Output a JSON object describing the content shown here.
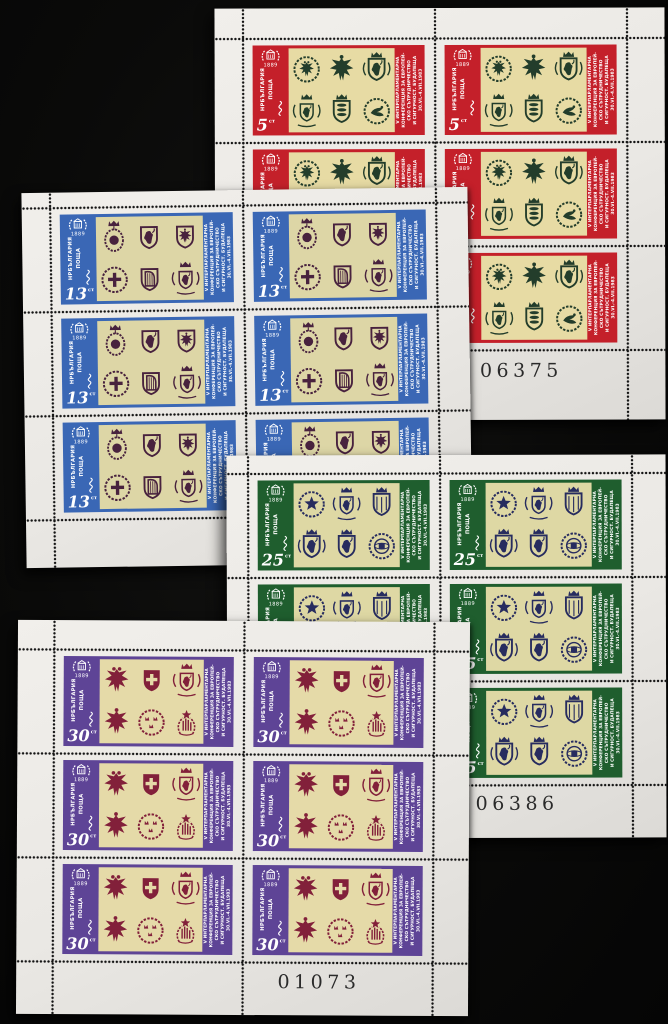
{
  "photo": {
    "background_color": "#0a0a09"
  },
  "shared": {
    "country_line1": "НРБЪЛГАРИЯ",
    "country_line2": "ПОЩА",
    "emblem_year": "1889",
    "currency_label": "ст",
    "side_text_lines": [
      "V ИНТЕРПАРЛАМЕНТАРНА",
      "КОНФЕРЕНЦИЯ ЗА ЕВРОПЕЙ-",
      "СКО СЪТРУДНИЧЕСТВО",
      "И СИГУРНОСТ. БУДАПЕЩА",
      "30.VI.-4.VII.1983"
    ]
  },
  "sheets": [
    {
      "id": "red-5",
      "denomination": "5",
      "serial": "06375",
      "frame_color": "#c4202a",
      "ink_color": "#233d2b",
      "panel_color": "#e7dba4",
      "arms": [
        {
          "label": "double-eagle-wreath-roundel",
          "glyph": "roundel:eagle"
        },
        {
          "label": "heraldic-eagle",
          "glyph": "eagle:1"
        },
        {
          "label": "crowned-lion-shield-with-supporters",
          "glyph": "shield:lion+crown+sup"
        },
        {
          "label": "royal-arms-with-supporters",
          "glyph": "royal"
        },
        {
          "label": "three-lions-crowned-shield",
          "glyph": "shield:lions+crown"
        },
        {
          "label": "dove-wreath-roundel",
          "glyph": "roundel:bird"
        }
      ]
    },
    {
      "id": "blue-13",
      "denomination": "13",
      "frame_color": "#3a67b5",
      "ink_color": "#48223e",
      "panel_color": "#ddd6a6",
      "arms": [
        {
          "label": "crowned-oval-medallion",
          "glyph": "medallion"
        },
        {
          "label": "lion-rampant-shield",
          "glyph": "shield:lion"
        },
        {
          "label": "eagle-shield",
          "glyph": "shield:eagle"
        },
        {
          "label": "cross-wreath-roundel",
          "glyph": "roundel:cross"
        },
        {
          "label": "harp-shield",
          "glyph": "shield:harp"
        },
        {
          "label": "crowned-arms-with-supporters",
          "glyph": "royal"
        }
      ]
    },
    {
      "id": "green-25",
      "denomination": "25",
      "serial": "06386",
      "frame_color": "#1f5e2e",
      "ink_color": "#272c5f",
      "panel_color": "#ded8a4",
      "arms": [
        {
          "label": "star-wreath-roundel",
          "glyph": "roundel:star"
        },
        {
          "label": "crowned-arms-with-supporters",
          "glyph": "royal"
        },
        {
          "label": "crowned-quartered-shield",
          "glyph": "shield:plain+crown"
        },
        {
          "label": "lion-arms-with-supporters",
          "glyph": "shield:lion+crown+sup"
        },
        {
          "label": "crowned-lion-shield",
          "glyph": "shield:lion+crown"
        },
        {
          "label": "armillary-sphere-roundel",
          "glyph": "roundel:sphere"
        }
      ]
    },
    {
      "id": "purple-30",
      "denomination": "30",
      "serial": "01073",
      "frame_color": "#5e4496",
      "ink_color": "#82203a",
      "panel_color": "#e5daa8",
      "arms": [
        {
          "label": "double-headed-eagle",
          "glyph": "eagle:2"
        },
        {
          "label": "cross-shield",
          "glyph": "shield:swisscross"
        },
        {
          "label": "royal-arms-with-supporters",
          "glyph": "royal"
        },
        {
          "label": "spread-eagle",
          "glyph": "eagle:1"
        },
        {
          "label": "three-crowns-roundel",
          "glyph": "roundel:crowns"
        },
        {
          "label": "flame-wreath-star-emblem",
          "glyph": "wreath"
        }
      ]
    }
  ]
}
